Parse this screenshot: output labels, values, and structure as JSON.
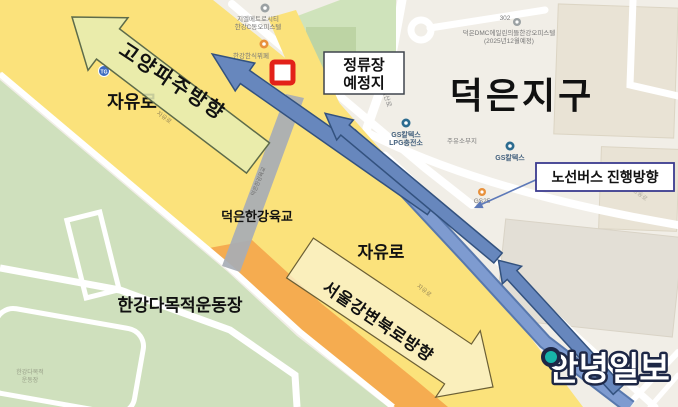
{
  "district": {
    "name": "덕은지구"
  },
  "roads": {
    "jayuro_bold_left": "자유로",
    "jayuro_bold_center": "자유로",
    "jayuro_small_left": "자유로",
    "jayuro_small_right": "자유로",
    "daedeoksanro": "대덕산로",
    "hyangdongro": "향동로",
    "overpass_name": "덕은한강육교",
    "overpass_name_small": "덕은한강육교"
  },
  "places": {
    "officetel_c": {
      "line1": "지엘메트로시티",
      "line2": "한강C동오피스텔"
    },
    "buffet": "한강한식뷔페",
    "building_number": "302",
    "officetel_dmc": {
      "line1": "덕은DMC에일린의뜰한강오피스텔",
      "line2": "(2025년12월예정)"
    },
    "park": "달맞이공원",
    "gs_lpg": {
      "line1": "GS칼텍스",
      "line2": "LPG충전소"
    },
    "gs": "GS칼텍스",
    "gas_station_site": "주유소부지",
    "gs25": "GS25",
    "stadium": "한강다목적운동장",
    "stadium_small": {
      "line1": "한강다목적",
      "line2": "운동장"
    },
    "tollgate": "TG"
  },
  "annotations": {
    "stop_label": {
      "line1": "정류장",
      "line2": "예정지"
    },
    "bus_direction_label": "노선버스 진행방향",
    "goyang_paju_arrow_label": "고양파주방향",
    "seoul_gangbyeon_arrow_label": "서울강변북로방향"
  },
  "watermark": "안녕일보",
  "colors": {
    "road_yellow": "#fbe27b",
    "road_orange": "#f5ac50",
    "route_blue": "#6787bd",
    "marker_red": "#e32119",
    "park_green": "#cfe0bd",
    "logo_teal": "#18b3a8",
    "bus_box_border": "#3b3b8f"
  }
}
